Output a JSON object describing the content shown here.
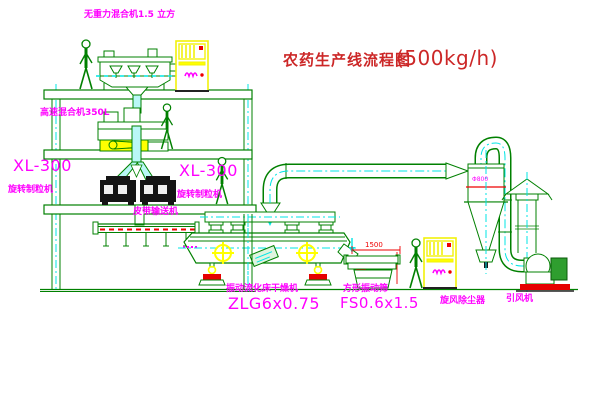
{
  "diagram": {
    "title": {
      "name": "农药生产线流程图",
      "capacity": "(500kg/h)"
    },
    "equipment_labels": {
      "gravity_mixer": "无重力混合机1.5 立方",
      "high_speed_mixer": "高速混合机350L",
      "granulator_left_model": "XL-300",
      "granulator_left_name": "旋转制粒机",
      "granulator_right_model": "XL-300",
      "granulator_right_name": "旋转制粒机",
      "belt_conveyor": "皮带输送机",
      "fluid_bed_dryer_name": "振动流化床干燥机",
      "fluid_bed_dryer_model": "ZLG6x0.75",
      "vibrating_screen_name": "方形振动筛",
      "vibrating_screen_model": "FS0.6x1.5",
      "cyclone_name": "旋风除尘器",
      "fan_name": "引风机",
      "cyclone_dia": "Φ800",
      "screen_dim_length": "1500"
    },
    "colors": {
      "line_green": "#008000",
      "centerline_cyan": "#00e5e5",
      "label_magenta": "#ff00ff",
      "title_red": "#cc2727",
      "accent_yellow": "#ffff00",
      "accent_red": "#ee0000"
    }
  }
}
